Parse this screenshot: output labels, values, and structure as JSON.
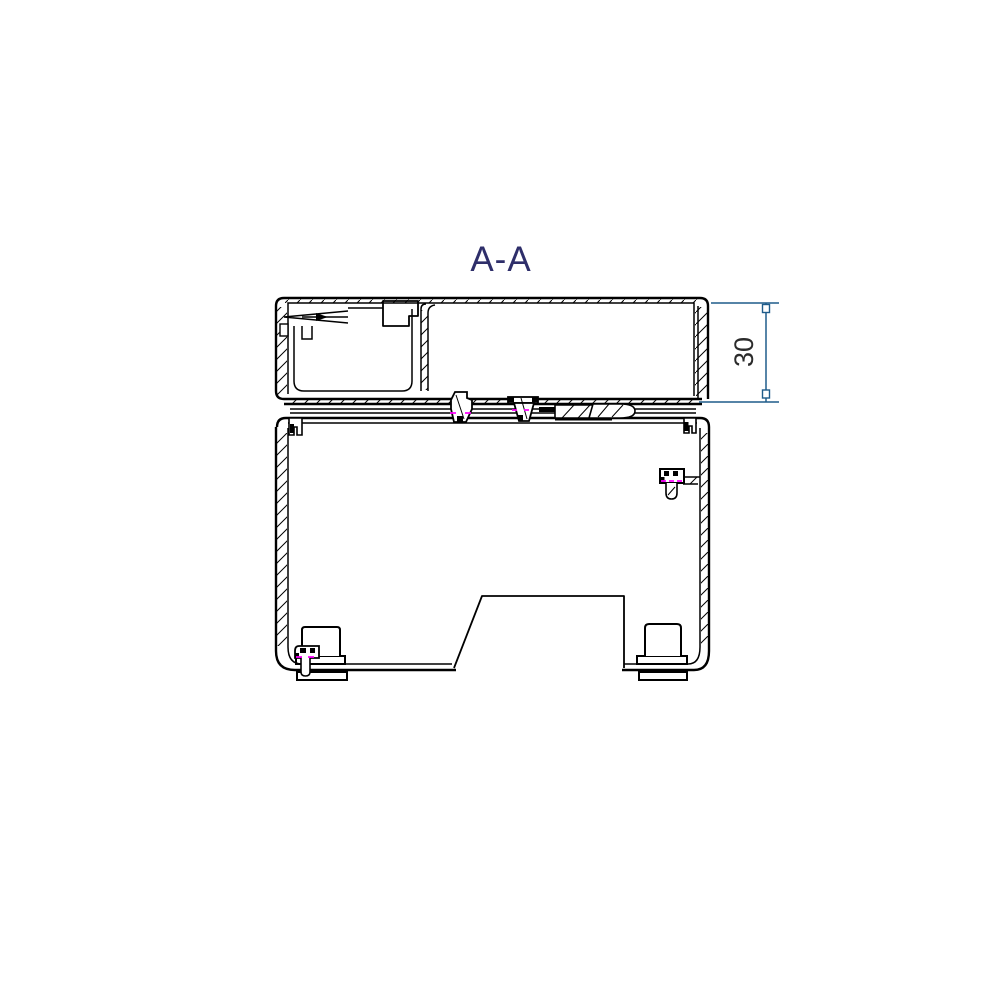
{
  "page": {
    "background": "#ffffff"
  },
  "view": {
    "label": "A-A",
    "type": "cross-section-technical-drawing"
  },
  "dimensions": [
    {
      "value": "30",
      "orientation": "vertical",
      "side": "right",
      "measures": "cover-height"
    }
  ],
  "colors": {
    "outline": "#000000",
    "title_text": "#2e2e6a",
    "dimension_line": "#1f5c8a",
    "dimension_text": "#2b2b2b",
    "marker": "#ff00ff",
    "background": "#ffffff"
  }
}
